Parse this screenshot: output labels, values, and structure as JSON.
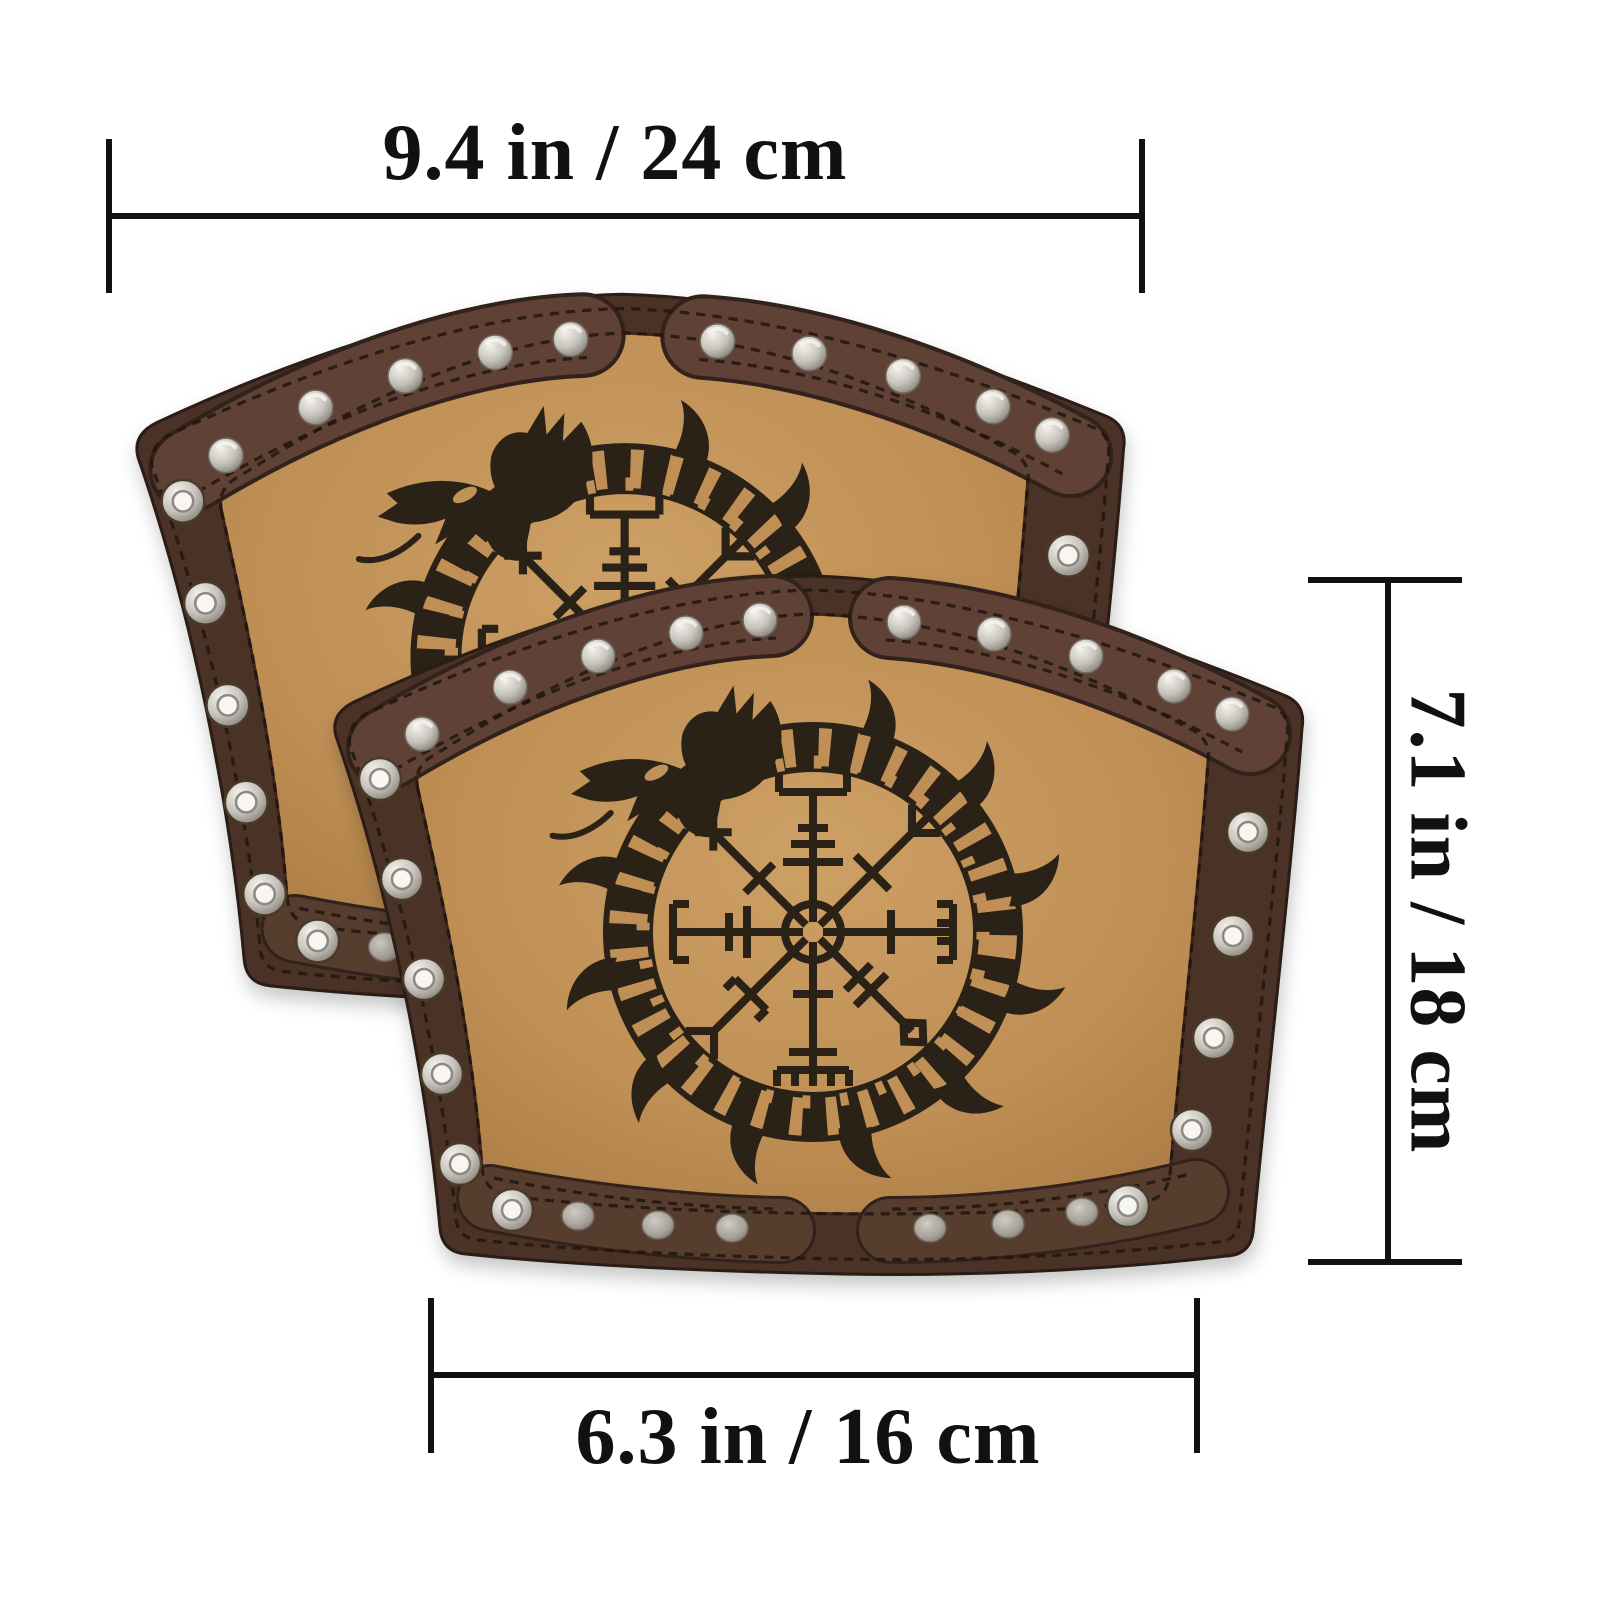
{
  "diagram": {
    "background": "#ffffff",
    "annotation_color": "#111111",
    "items_shown": 2,
    "product": "leather-arm-bracer-pair",
    "motifs": [
      "ouroboros-dragon-motif",
      "vegvisir-compass-symbol"
    ],
    "hardware": [
      "dome-rivet",
      "flat-rivet",
      "grommet-eyelet"
    ]
  },
  "dimensions": {
    "top_width": {
      "label": "9.4 in / 24 cm"
    },
    "height": {
      "label": "7.1 in / 18 cm"
    },
    "bottom_width": {
      "label": "6.3 in / 16 cm"
    }
  },
  "colors": {
    "leather_border": "#4b3326",
    "leather_strap": "#5e4334",
    "leather_panel": "#c09159",
    "engraving": "#2b2014",
    "rivet_silver": "#c6c3bc",
    "stitch": "#241710"
  }
}
